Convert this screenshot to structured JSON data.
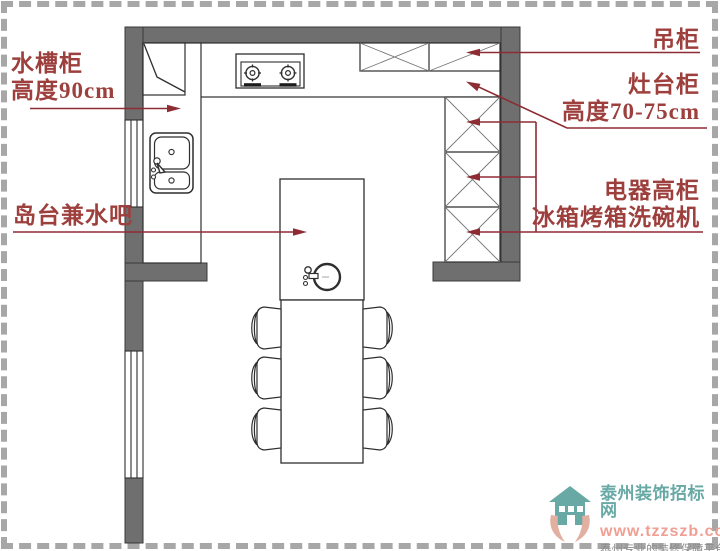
{
  "plan_labels": {
    "sink_cabinet_line1": "水槽柜",
    "sink_cabinet_line2": "高度90cm",
    "island_bar": "岛台兼水吧",
    "hanging_cabinet": "吊柜",
    "stove_cabinet_line1": "灶台柜",
    "stove_cabinet_line2": "高度70-75cm",
    "appliance_cabinet_line1": "电器高柜",
    "appliance_cabinet_line2": "冰箱烤箱洗碗机"
  },
  "watermark": {
    "site_name": "泰州装饰招标网",
    "url": "www.tzzszb.com",
    "tagline": "泰州专业的装修保障平台"
  },
  "colors": {
    "label_red": "#9d3f3c",
    "leader_red": "#8e2c33",
    "wall_gray": "#6f6f6f",
    "line_black": "#2f2f2f",
    "watermark_teal": "#68a9a6",
    "watermark_salmon": "#ef9f93",
    "watermark_gray": "#8d8d8d",
    "border_dash_gray": "#a7a7a7"
  }
}
